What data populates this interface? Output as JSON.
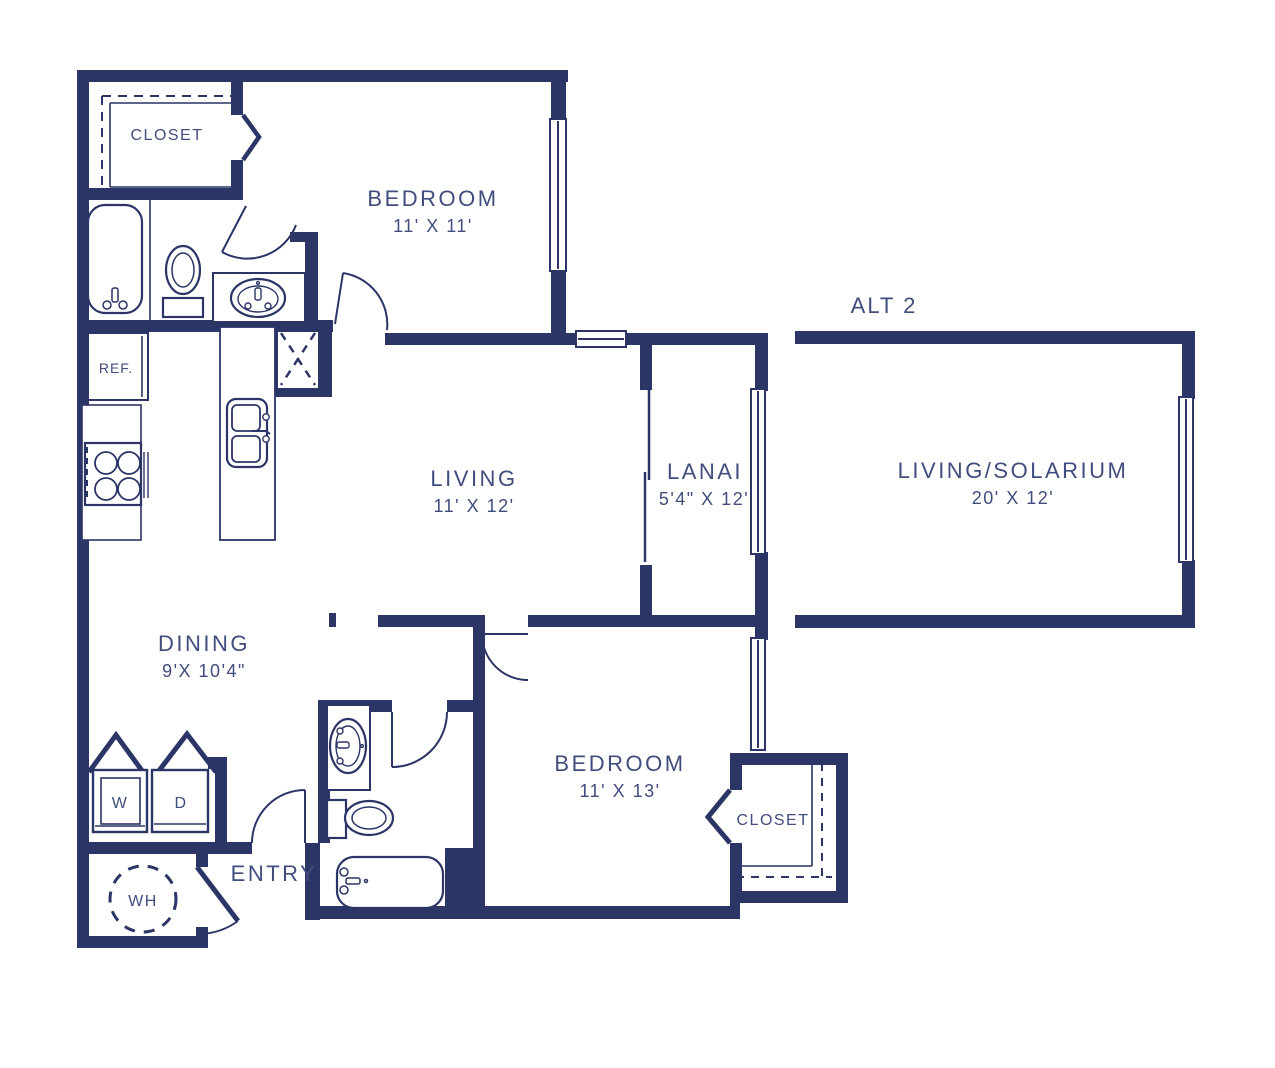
{
  "plan": {
    "alt_label": "ALT 2",
    "rooms": {
      "closet1": {
        "label": "CLOSET"
      },
      "bedroom1": {
        "label": "BEDROOM",
        "dims": "11' X 11'"
      },
      "living": {
        "label": "LIVING",
        "dims": "11' X 12'"
      },
      "lanai": {
        "label": "LANAI",
        "dims": "5'4\" X 12'"
      },
      "solarium": {
        "label": "LIVING/SOLARIUM",
        "dims": "20' X 12'"
      },
      "dining": {
        "label": "DINING",
        "dims": "9'X 10'4\""
      },
      "bedroom2": {
        "label": "BEDROOM",
        "dims": "11' X 13'"
      },
      "closet2": {
        "label": "CLOSET"
      },
      "entry": {
        "label": "ENTRY"
      }
    },
    "appliances": {
      "refrigerator": "REF.",
      "washer": "W",
      "dryer": "D",
      "water_heater": "WH"
    },
    "colors": {
      "wall": "#2b3566",
      "text": "#404d7d"
    }
  }
}
